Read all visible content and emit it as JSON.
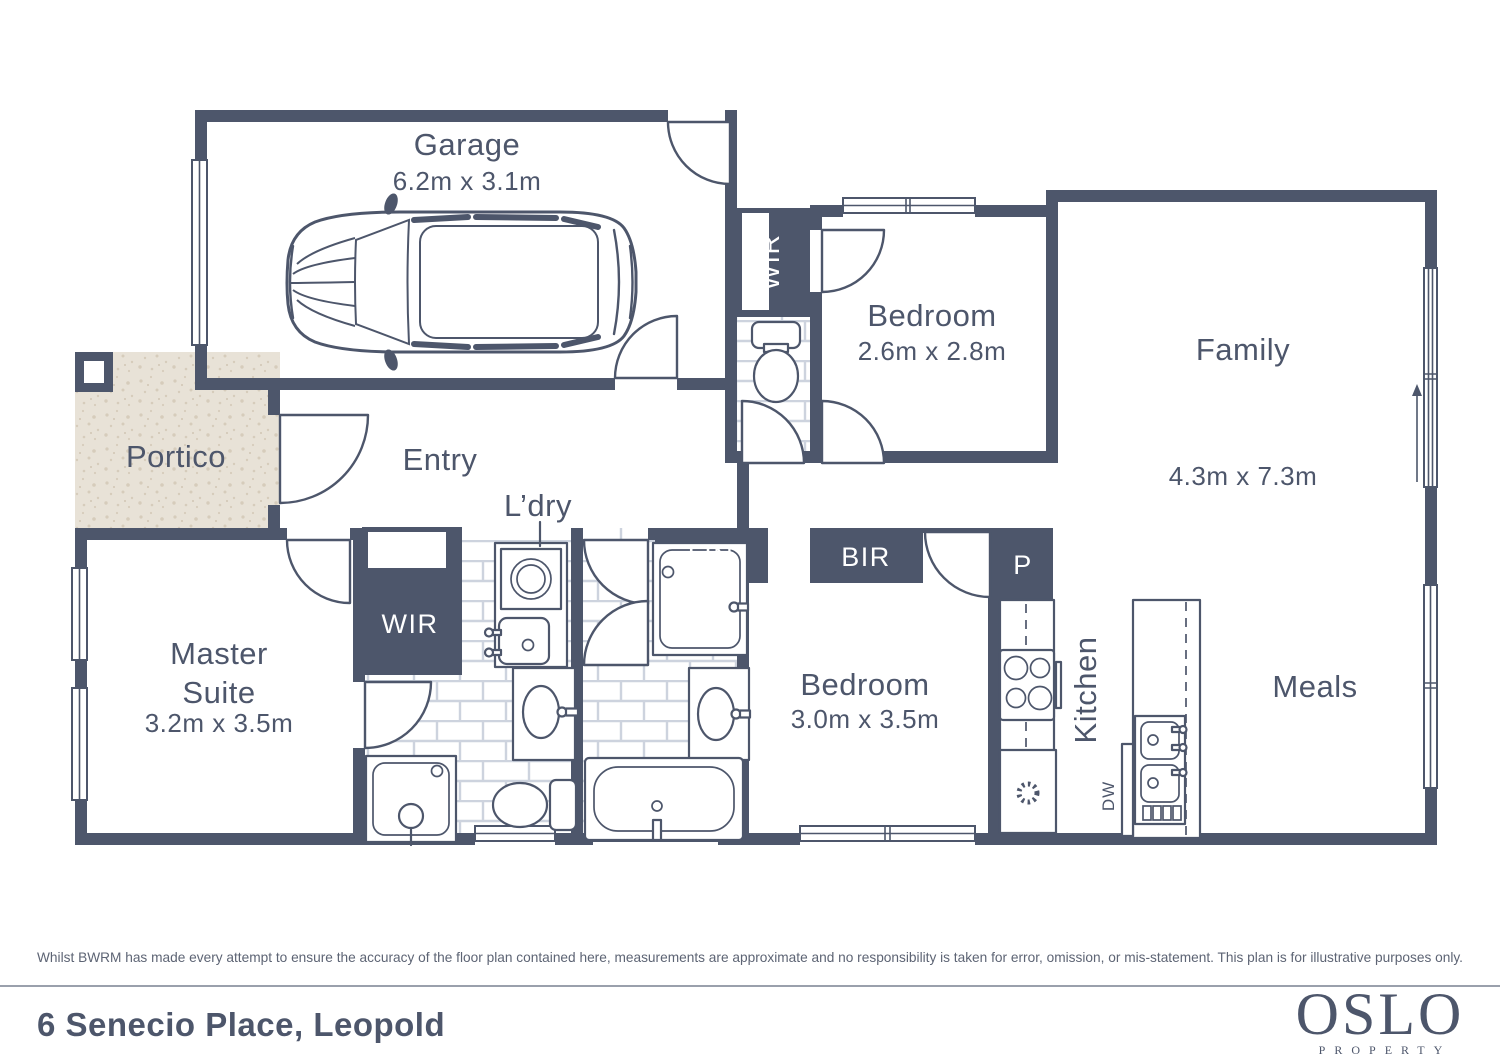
{
  "colors": {
    "wall": "#4d566b",
    "ink": "#4d566b",
    "tile_line": "#cdd3de",
    "portico_base": "#e8e2d7",
    "portico_speck": "#d6ccbb",
    "band_text": "#ffffff",
    "muted": "#5d6474",
    "divider": "#9aa0ac",
    "page_bg": "#ffffff"
  },
  "rooms": {
    "garage": {
      "name": "Garage",
      "dims": "6.2m x 3.1m"
    },
    "portico": {
      "name": "Portico"
    },
    "entry": {
      "name": "Entry"
    },
    "laundry": {
      "name": "L’dry"
    },
    "wir_bedroom": {
      "label": "WIR"
    },
    "bedroom1": {
      "name": "Bedroom",
      "dims": "2.6m x 2.8m"
    },
    "family": {
      "name": "Family",
      "dims": "4.3m x 7.3m"
    },
    "master": {
      "line1": "Master",
      "line2": "Suite",
      "dims": "3.2m x 3.5m"
    },
    "wir_master": {
      "label": "WIR"
    },
    "linen": {
      "label": "LIN"
    },
    "robe": {
      "label": "BIR"
    },
    "bedroom2": {
      "name": "Bedroom",
      "dims": "3.0m x 3.5m"
    },
    "pantry": {
      "label": "P"
    },
    "kitchen": {
      "name": "Kitchen"
    },
    "dishwasher": {
      "label": "DW"
    },
    "meals": {
      "name": "Meals"
    }
  },
  "footer": {
    "disclaimer": "Whilst BWRM  has made every attempt to ensure the accuracy of the floor plan contained here, measurements are approximate and no responsibility is taken for error, omission, or mis-statement. This plan is for illustrative purposes only.",
    "address": "6 Senecio Place, Leopold",
    "logo": {
      "title": "OSLO",
      "subtitle": "PROPERTY"
    }
  }
}
